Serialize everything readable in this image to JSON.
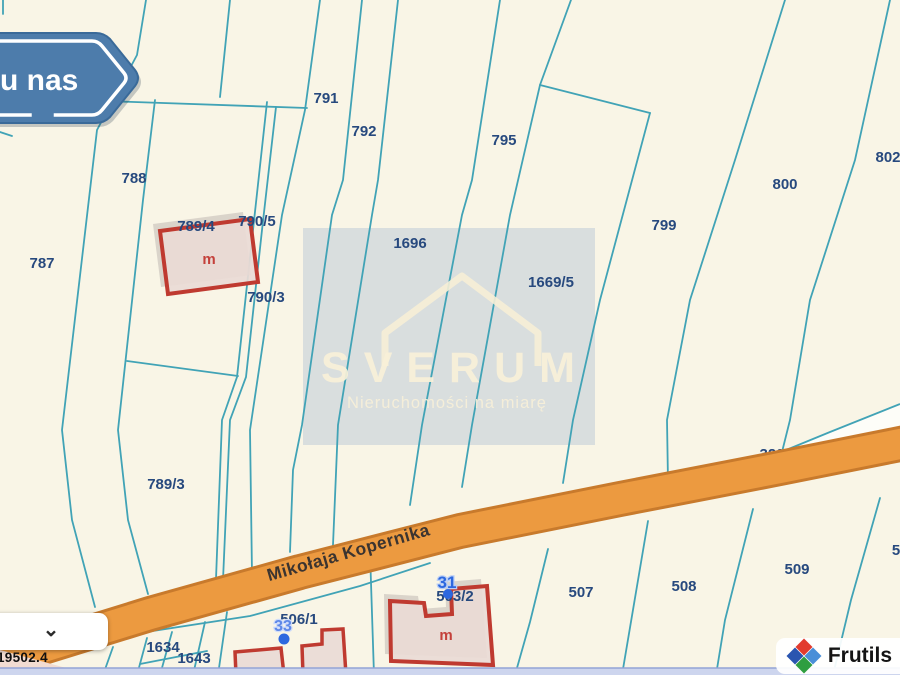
{
  "sign": {
    "text": "u nas"
  },
  "watermark": {
    "brand": "SVERUM",
    "tagline": "Nieruchomości na miarę"
  },
  "road": {
    "name": "Mikołaja Kopernika"
  },
  "parcels": {
    "p787": "787",
    "p788": "788",
    "p789_4": "789/4",
    "p790_5": "790/5",
    "p790_3": "790/3",
    "p789_3": "789/3",
    "p791": "791",
    "p792": "792",
    "p795": "795",
    "p1696": "1696",
    "p1669_5": "1669/5",
    "p799": "799",
    "p800": "800",
    "p802": "802",
    "p320": "320",
    "p1634": "1634",
    "p1643": "1643",
    "p506_1": "506/1",
    "p503_2": "503/2",
    "p507": "507",
    "p508": "508",
    "p509": "509",
    "p5xx": "5"
  },
  "buildings": {
    "letter": "m"
  },
  "markers": {
    "m31": "31",
    "m33": "33"
  },
  "status": {
    "coordinate": "19502.4"
  },
  "attribution": {
    "brand": "Frutils"
  },
  "icons": {
    "chevron_down": "⌄"
  },
  "colors": {
    "background": "#f9f5e6",
    "parcel_line": "#41a3b6",
    "parcel_label": "#27497e",
    "road_fill": "#ec9a40",
    "road_casing": "#c87a2c",
    "building_stroke": "#bf3a30",
    "building_fill": "#e9dad5",
    "marker_blue": "#2d68df",
    "sign_blue": "#4d7cab",
    "watermark_gray": "#d2d9dc",
    "bottom_band": "#cdd5ee"
  }
}
